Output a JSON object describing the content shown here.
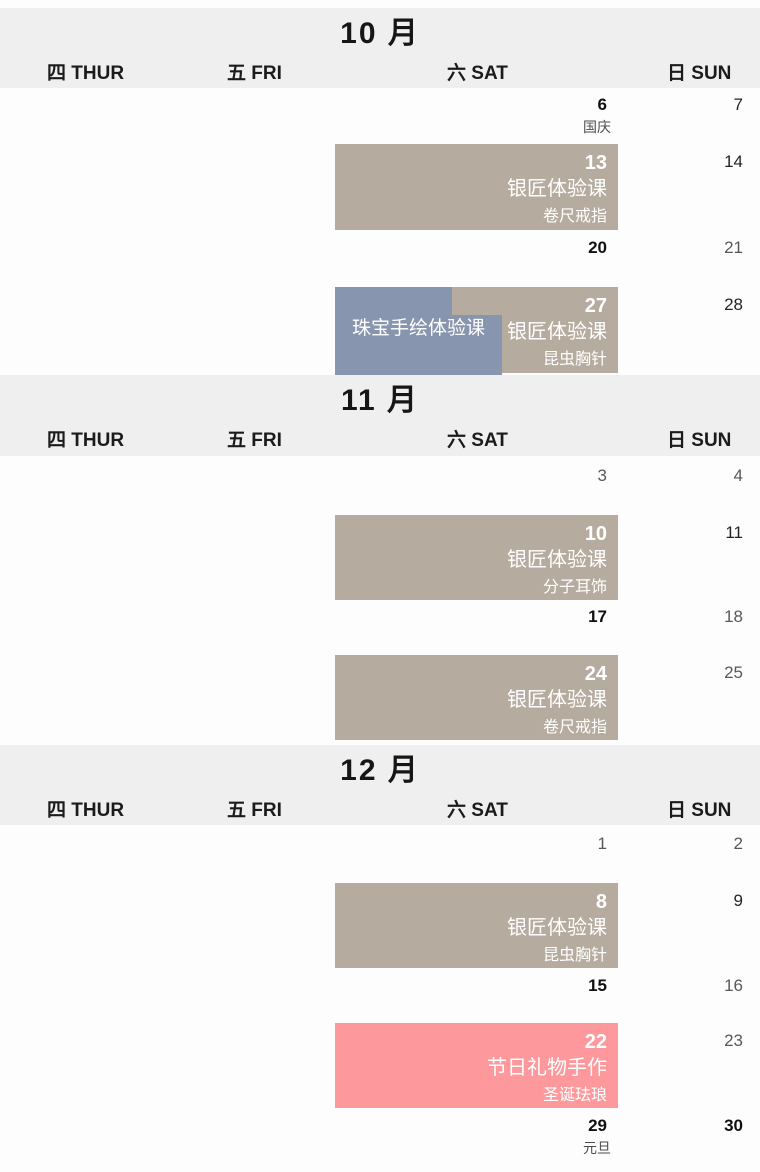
{
  "colors": {
    "band_bg": "#f0eff0",
    "event_tan": "#b6ab9f",
    "event_blue": "#8795ae",
    "event_pink": "#fd999c",
    "event_text": "#ffffff"
  },
  "weekdays": {
    "thu": "四 THUR",
    "fri": "五 FRI",
    "sat": "六 SAT",
    "sun": "日 SUN"
  },
  "months": [
    {
      "title": "10 月",
      "days": {
        "n6": "6",
        "n7": "7",
        "n14": "14",
        "n20": "20",
        "n21": "21",
        "n28": "28"
      },
      "notes": {
        "national_day": "国庆"
      },
      "events": {
        "oct13": {
          "day": "13",
          "title": "银匠体验课",
          "subtitle": "卷尺戒指"
        },
        "oct27": {
          "day": "27",
          "title": "银匠体验课",
          "subtitle": "昆虫胸针"
        },
        "oct27_blue": {
          "title": "珠宝手绘体验课"
        }
      }
    },
    {
      "title": "11 月",
      "days": {
        "n3": "3",
        "n4": "4",
        "n11": "11",
        "n17": "17",
        "n18": "18",
        "n25": "25"
      },
      "events": {
        "nov10": {
          "day": "10",
          "title": "银匠体验课",
          "subtitle": "分子耳饰"
        },
        "nov24": {
          "day": "24",
          "title": "银匠体验课",
          "subtitle": "卷尺戒指"
        }
      }
    },
    {
      "title": "12 月",
      "days": {
        "n1": "1",
        "n2": "2",
        "n9": "9",
        "n15": "15",
        "n16": "16",
        "n23": "23",
        "n29": "29",
        "n30": "30"
      },
      "notes": {
        "new_year": "元旦"
      },
      "events": {
        "dec8": {
          "day": "8",
          "title": "银匠体验课",
          "subtitle": "昆虫胸针"
        },
        "dec22": {
          "day": "22",
          "title": "节日礼物手作",
          "subtitle": "圣诞珐琅"
        }
      }
    }
  ]
}
